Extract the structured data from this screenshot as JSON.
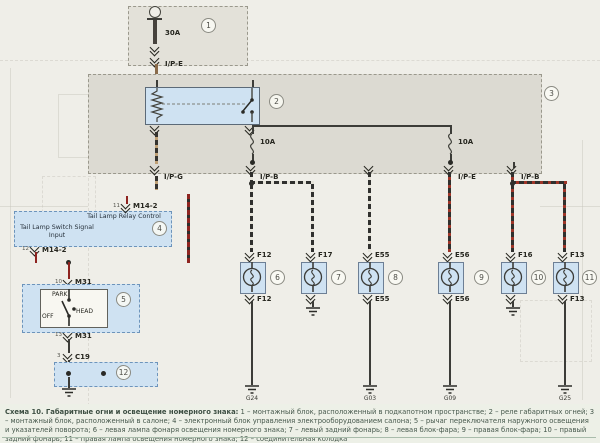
{
  "caption": {
    "title": "Схема 10. Габаритные огни и освещение номерного знака:",
    "body": " 1 – монтажный блок, расположенный в подкапотном пространстве; 2 – реле габаритных огней; 3 – монтажный блок, расположенный в салоне; 4 – электронный блок управления электрооборудованием салона; 5 – рычаг переключателя наружного освещения и указателей поворота; 6 – левая лампа фонаря освещения номерного знака; 7 – левый задний фонарь; 8 – левая блок-фара; 9 – правая блок-фара; 10 – правый задний фонарь; 11 – правая лампа освещения номерного знака; 12 – соединительная колодка"
  },
  "callouts": [
    "1",
    "2",
    "3",
    "4",
    "5",
    "6",
    "7",
    "8",
    "9",
    "10",
    "11",
    "12"
  ],
  "power": {
    "fuse_main": "30A",
    "wire_top": "I/P-E"
  },
  "cabin_block": {
    "fuse_left": "10A",
    "fuse_right": "10A",
    "exit_ipg": "I/P-G",
    "exit_ipb_left": "I/P-B",
    "exit_ipe": "I/P-E",
    "exit_ipb_right": "I/P-B"
  },
  "bcm": {
    "relay_control": "Tail Lamp Relay Control",
    "switch_input": "Tail Lamp Switch Signal Input",
    "conn_top_name": "M14-2",
    "conn_top_pin": "11",
    "conn_bot_name": "M14-2",
    "conn_bot_pin": "12"
  },
  "lightswitch": {
    "pos_off": "OFF",
    "pos_park": "PARK",
    "pos_head": "HEAD",
    "conn_top_name": "M31",
    "conn_top_pin": "10",
    "conn_bot_name": "M31",
    "conn_bot_pin": "13",
    "conn_c19_name": "C19",
    "conn_c19_pin": "3"
  },
  "lamps": [
    {
      "id": "F12",
      "callout": "6",
      "ground": "G24"
    },
    {
      "id": "F17",
      "callout": "7",
      "ground": ""
    },
    {
      "id": "E55",
      "callout": "8",
      "ground": "G03"
    },
    {
      "id": "E56",
      "callout": "9",
      "ground": "G09"
    },
    {
      "id": "F16",
      "callout": "10",
      "ground": ""
    },
    {
      "id": "F13",
      "callout": "11",
      "ground": "G25"
    }
  ]
}
